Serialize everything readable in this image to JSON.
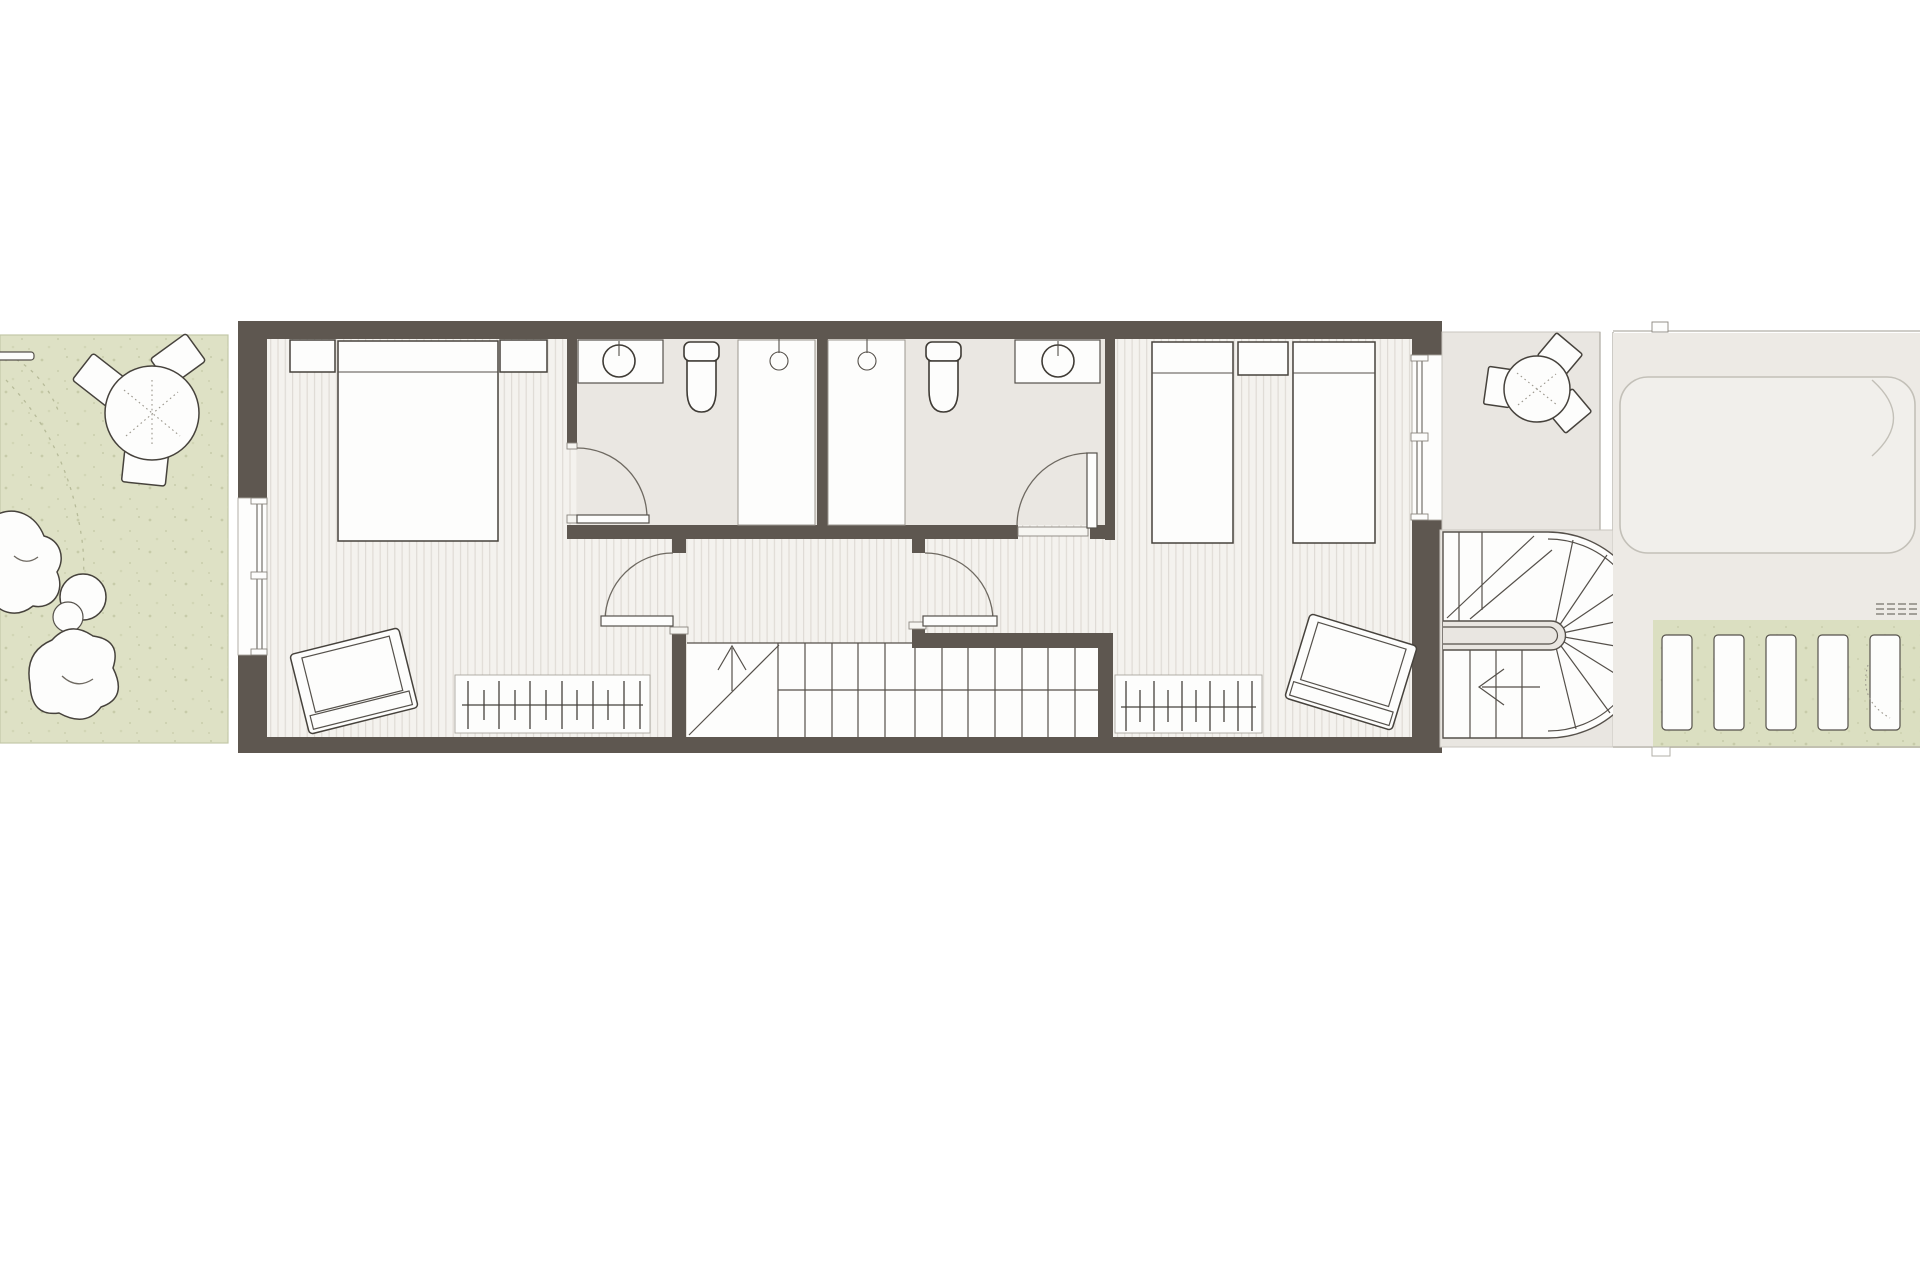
{
  "document": {
    "title": "Terraced house floor plan — bedroom level",
    "drawing_type": "architectural plan view",
    "visible_text": "none"
  },
  "colors": {
    "background": "#ffffff",
    "wall": "#5e5750",
    "floor_base": "#f4f2ee",
    "floor_stripe": "#dfdbd5",
    "bathroom_floor": "#eae7e2",
    "terrace_floor": "#e9e6e1",
    "driveway": "#edeae5",
    "car_fill": "#f1efeb",
    "car_outline": "#c3c0b8",
    "garden_green": "#dee1c5",
    "garden_speckle": "#c7cba9",
    "path_green": "#dbdfc1",
    "furniture_fill": "#fdfdfc",
    "outline_dark": "#46423c",
    "stair_line": "#55504a"
  },
  "rooms": [
    {
      "id": "garden",
      "name": "Rear garden"
    },
    {
      "id": "master-bedroom",
      "name": "Bedroom 1 (master)"
    },
    {
      "id": "ensuite-bathroom",
      "name": "En-suite bathroom"
    },
    {
      "id": "family-bathroom",
      "name": "Bathroom"
    },
    {
      "id": "hallway",
      "name": "Landing / hallway"
    },
    {
      "id": "staircase",
      "name": "Internal staircase"
    },
    {
      "id": "bedroom-2",
      "name": "Bedroom 2 (twin)"
    },
    {
      "id": "terrace",
      "name": "Front terrace"
    },
    {
      "id": "external-staircase",
      "name": "External curved staircase"
    },
    {
      "id": "driveway",
      "name": "Driveway / parking"
    },
    {
      "id": "garden-path",
      "name": "Plank path on lawn"
    }
  ],
  "furniture": {
    "garden": [
      "round dining table",
      "three garden chairs",
      "bench",
      "two bean-bag cushions",
      "two pebble poufs"
    ],
    "master_bedroom": [
      "double bed",
      "two nightstands",
      "armchair",
      "radiator"
    ],
    "ensuite_bathroom": [
      "washbasin on counter",
      "toilet",
      "shower tray",
      "shower head"
    ],
    "family_bathroom": [
      "washbasin on counter",
      "toilet",
      "shower tray",
      "shower head"
    ],
    "bedroom_2": [
      "single bed",
      "single bed",
      "shared nightstand",
      "armchair",
      "radiator"
    ],
    "terrace": [
      "round bistro table",
      "three chairs"
    ],
    "driveway": [
      "parked car"
    ],
    "garden_path": [
      "five plank pavers"
    ]
  },
  "doors": [
    {
      "id": "door-a",
      "connects": "master bedroom to en-suite"
    },
    {
      "id": "door-b",
      "connects": "hallway to bathroom"
    },
    {
      "id": "door-c",
      "connects": "hallway to master bedroom"
    },
    {
      "id": "door-d",
      "connects": "hallway to bedroom 2"
    }
  ],
  "stairs": {
    "internal": {
      "direction_arrow": "up",
      "treads": 12,
      "flights": 2
    },
    "external": {
      "shape": "half-turn with curved end",
      "direction_arrow": "left"
    }
  }
}
